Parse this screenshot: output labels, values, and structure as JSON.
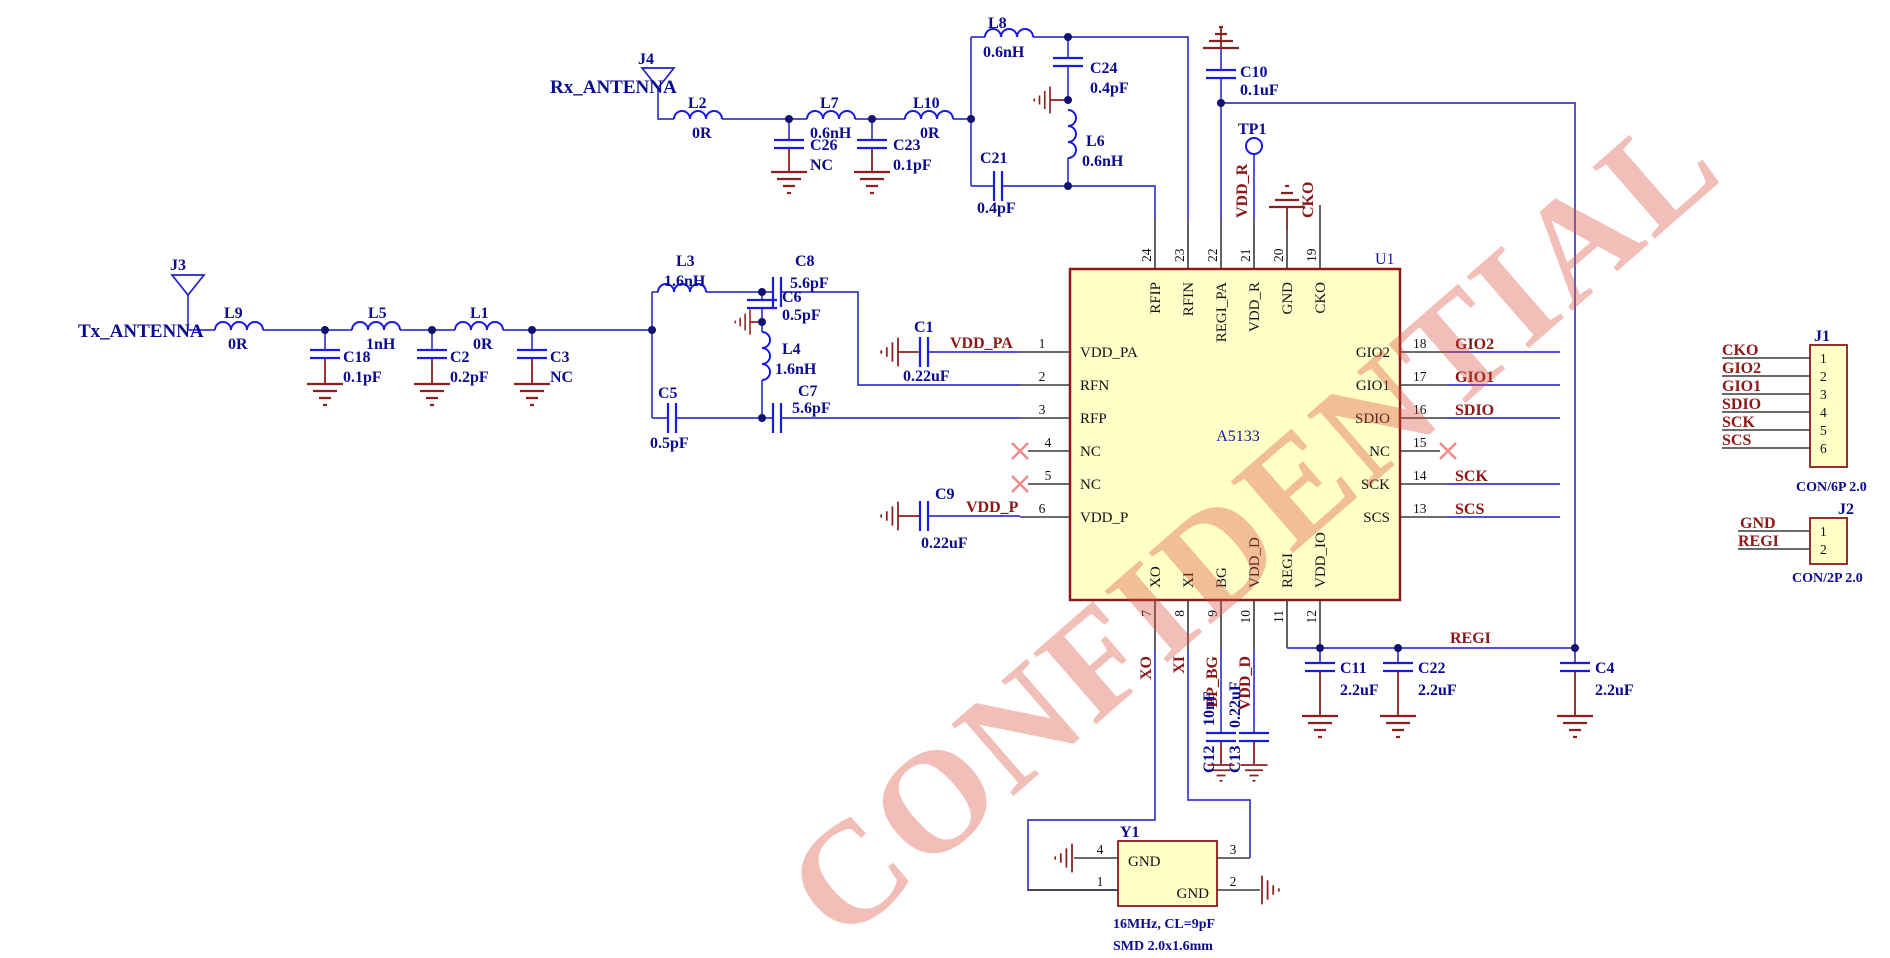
{
  "watermark": "CONFIDENTIAL",
  "colors": {
    "chip_fill": "#FFFFC8",
    "chip_border": "#8B1A1A",
    "wire": "#3A3AC8",
    "component": "#1A1AE0",
    "label": "#0B0B8F",
    "net_label": "#8B1717",
    "watermark": "#DD4E3C"
  },
  "antennas": {
    "rx": {
      "ref": "J4",
      "net": "Rx_ANTENNA"
    },
    "tx": {
      "ref": "J3",
      "net": "Tx_ANTENNA"
    }
  },
  "parts": {
    "L2": {
      "ref": "L2",
      "val": "0R"
    },
    "L7": {
      "ref": "L7",
      "val": "0.6nH"
    },
    "L10": {
      "ref": "L10",
      "val": "0R"
    },
    "L8": {
      "ref": "L8",
      "val": "0.6nH"
    },
    "L6": {
      "ref": "L6",
      "val": "0.6nH"
    },
    "L9": {
      "ref": "L9",
      "val": "0R"
    },
    "L5": {
      "ref": "L5",
      "val": "1nH"
    },
    "L1": {
      "ref": "L1",
      "val": "0R"
    },
    "L3": {
      "ref": "L3",
      "val": "1.6nH"
    },
    "L4": {
      "ref": "L4",
      "val": "1.6nH"
    },
    "C26": {
      "ref": "C26",
      "val": "NC"
    },
    "C23": {
      "ref": "C23",
      "val": "0.1pF"
    },
    "C24": {
      "ref": "C24",
      "val": "0.4pF"
    },
    "C21": {
      "ref": "C21",
      "val": "0.4pF"
    },
    "C10": {
      "ref": "C10",
      "val": "0.1uF"
    },
    "C18": {
      "ref": "C18",
      "val": "0.1pF"
    },
    "C2": {
      "ref": "C2",
      "val": "0.2pF"
    },
    "C3": {
      "ref": "C3",
      "val": "NC"
    },
    "C8": {
      "ref": "C8",
      "val": "5.6pF"
    },
    "C6": {
      "ref": "C6",
      "val": "0.5pF"
    },
    "C5": {
      "ref": "C5",
      "val": "0.5pF"
    },
    "C7": {
      "ref": "C7",
      "val": "5.6pF"
    },
    "C1": {
      "ref": "C1",
      "val": "0.22uF"
    },
    "C9": {
      "ref": "C9",
      "val": "0.22uF"
    },
    "C12": {
      "ref": "C12",
      "val": "10nF"
    },
    "C13": {
      "ref": "C13",
      "val": "0.22uF"
    },
    "C11": {
      "ref": "C11",
      "val": "2.2uF"
    },
    "C22": {
      "ref": "C22",
      "val": "2.2uF"
    },
    "C4": {
      "ref": "C4",
      "val": "2.2uF"
    }
  },
  "ic": {
    "ref": "U1",
    "name": "A5133",
    "left": [
      {
        "n": "1",
        "name": "VDD_PA"
      },
      {
        "n": "2",
        "name": "RFN"
      },
      {
        "n": "3",
        "name": "RFP"
      },
      {
        "n": "4",
        "name": "NC"
      },
      {
        "n": "5",
        "name": "NC"
      },
      {
        "n": "6",
        "name": "VDD_P"
      }
    ],
    "top": [
      {
        "n": "24",
        "name": "RFIP"
      },
      {
        "n": "23",
        "name": "RFIN"
      },
      {
        "n": "22",
        "name": "REGI_PA"
      },
      {
        "n": "21",
        "name": "VDD_R"
      },
      {
        "n": "20",
        "name": "GND"
      },
      {
        "n": "19",
        "name": "CKO"
      }
    ],
    "right": [
      {
        "n": "18",
        "name": "GIO2",
        "net": "GIO2"
      },
      {
        "n": "17",
        "name": "GIO1",
        "net": "GIO1"
      },
      {
        "n": "16",
        "name": "SDIO",
        "net": "SDIO"
      },
      {
        "n": "15",
        "name": "NC",
        "net": ""
      },
      {
        "n": "14",
        "name": "SCK",
        "net": "SCK"
      },
      {
        "n": "13",
        "name": "SCS",
        "net": "SCS"
      }
    ],
    "bottom": [
      {
        "n": "7",
        "name": "XO",
        "net": "XO"
      },
      {
        "n": "8",
        "name": "XI",
        "net": "XI"
      },
      {
        "n": "9",
        "name": "BG",
        "net": "BP_BG"
      },
      {
        "n": "10",
        "name": "VDD_D",
        "net": "VDD_D"
      },
      {
        "n": "11",
        "name": "REGI",
        "net": ""
      },
      {
        "n": "12",
        "name": "VDD_IO",
        "net": ""
      }
    ]
  },
  "nets": {
    "vdd_pa": "VDD_PA",
    "vdd_p": "VDD_P",
    "vdd_r": "VDD_R",
    "cko": "CKO",
    "regi": "REGI"
  },
  "testpoint": {
    "ref": "TP1"
  },
  "crystal": {
    "ref": "Y1",
    "gnd_top": "GND",
    "gnd_bottom": "GND",
    "pin_tl": "4",
    "pin_tr": "3",
    "pin_bl": "1",
    "pin_br": "2",
    "note1": "16MHz, CL=9pF",
    "note2": "SMD 2.0x1.6mm"
  },
  "j1": {
    "ref": "J1",
    "type": "CON/6P 2.0",
    "rows": [
      {
        "n": "1",
        "net": "CKO"
      },
      {
        "n": "2",
        "net": "GIO2"
      },
      {
        "n": "3",
        "net": "GIO1"
      },
      {
        "n": "4",
        "net": "SDIO"
      },
      {
        "n": "5",
        "net": "SCK"
      },
      {
        "n": "6",
        "net": "SCS"
      }
    ]
  },
  "j2": {
    "ref": "J2",
    "type": "CON/2P 2.0",
    "rows": [
      {
        "n": "1",
        "net": "GND"
      },
      {
        "n": "2",
        "net": "REGI"
      }
    ]
  }
}
